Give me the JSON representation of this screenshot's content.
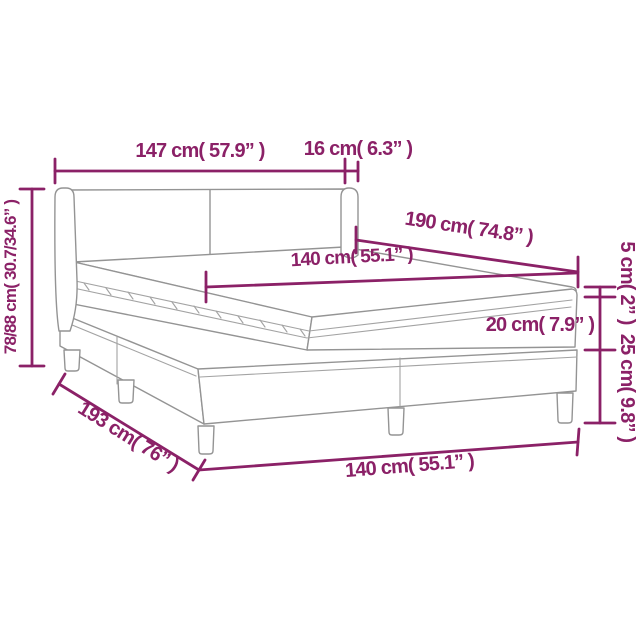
{
  "diagram": {
    "kind": "bed-dimension-diagram",
    "colors": {
      "annotation": "#8b2167",
      "drawing_outline": "#949494",
      "background": "#ffffff"
    },
    "measurements": {
      "headboard_width": "147 cm( 57.9” )",
      "headboard_depth": "16 cm( 6.3” )",
      "headboard_height": "78/88 cm( 30.7/34.6” )",
      "bed_length_diagonal": "190 cm( 74.8” )",
      "mattress_width": "140 cm( 55.1” )",
      "topper_height": "5 cm( 2” )",
      "mattress_height": "20 cm( 7.9” )",
      "base_height": "25 cm( 9.8” )",
      "bed_length": "193 cm( 76” )",
      "bed_width": "140 cm( 55.1” )"
    }
  }
}
